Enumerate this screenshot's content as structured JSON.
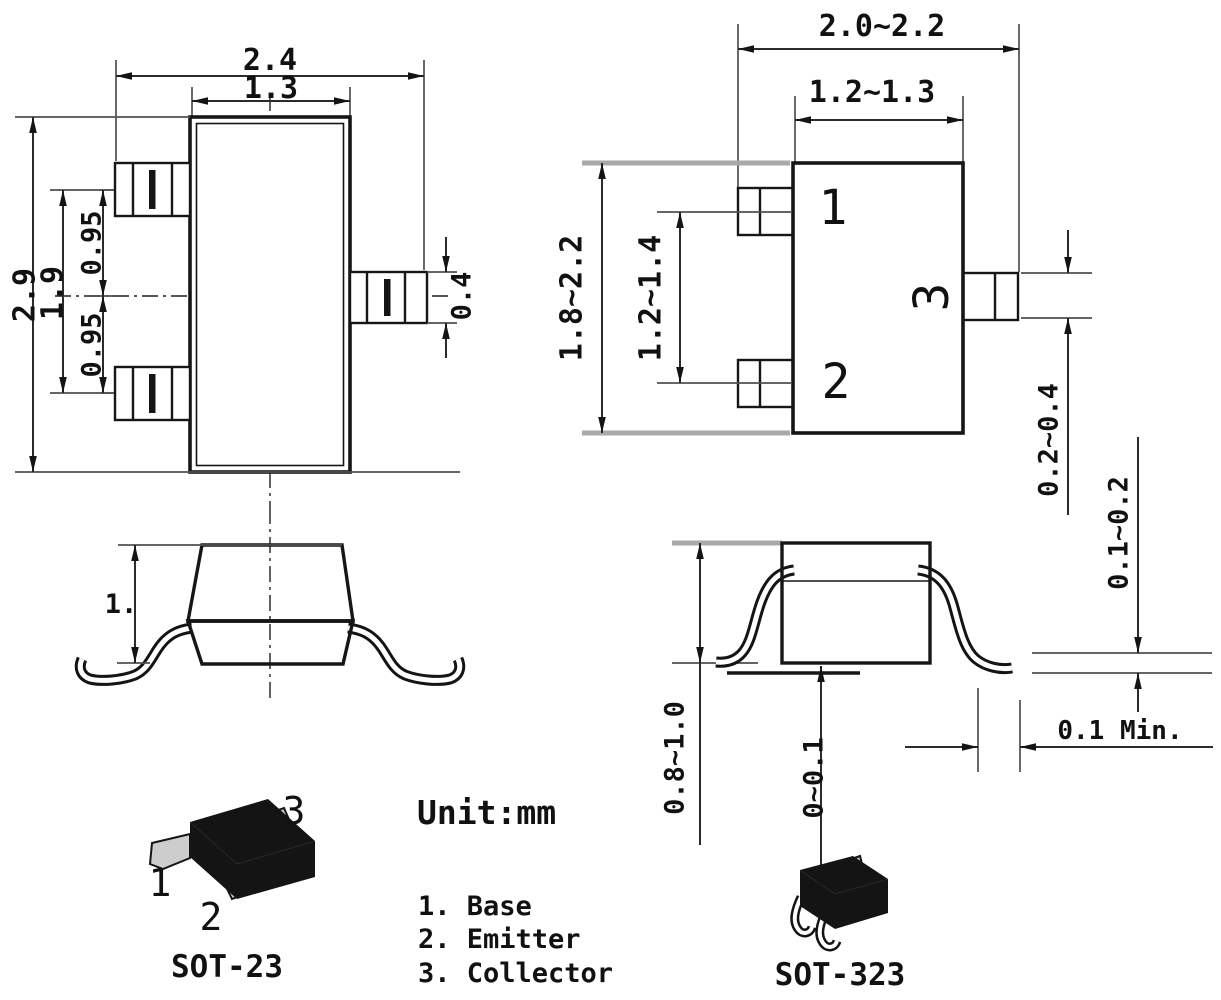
{
  "drawing": {
    "unit_note": "Unit:mm",
    "pin_legend": [
      "1. Base",
      "2. Emitter",
      "3. Collector"
    ],
    "sot23": {
      "label": "SOT-23",
      "top": {
        "overall_width": "2.4",
        "body_width": "1.3",
        "overall_height": "2.9",
        "lead_span": "1.9",
        "pitch_upper": "0.95",
        "pitch_lower": "0.95",
        "lead_width": "0.4"
      },
      "side": {
        "height": "1."
      },
      "pins": {
        "p1": "1",
        "p2": "2",
        "p3": "3"
      }
    },
    "sot323": {
      "label": "SOT-323",
      "top": {
        "overall_width": "2.0~2.2",
        "body_width": "1.2~1.3",
        "overall_height": "1.8~2.2",
        "lead_pitch": "1.2~1.4",
        "lead_width": "0.2~0.4"
      },
      "side": {
        "height": "0.8~1.0",
        "standoff": "0~0.1",
        "lead_thickness": "0.1~0.2",
        "foot_length_min": "0.1 Min."
      },
      "pins": {
        "p1": "1",
        "p2": "2",
        "p3": "3"
      }
    }
  }
}
